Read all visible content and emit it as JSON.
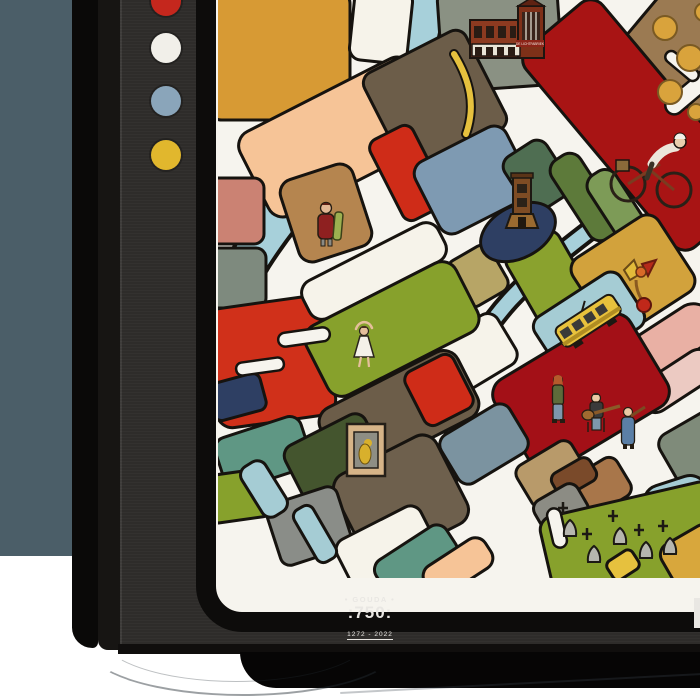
{
  "scene": {
    "wall_color": "#4b5e68",
    "floor_color": "#ffffff",
    "shadow_color": "#060505"
  },
  "frame": {
    "front_color": "#2f2d2b",
    "side_color": "#0a0908",
    "side_color2": "#171513",
    "inner_border_color": "#0d0c0b",
    "dots": [
      {
        "name": "red-dot",
        "color": "#c5271d"
      },
      {
        "name": "white-dot",
        "color": "#f1efe9"
      },
      {
        "name": "blue-dot",
        "color": "#8aa5ba"
      },
      {
        "name": "yellow-dot",
        "color": "#e1b72d"
      }
    ],
    "logo": {
      "line1": "• GOUDA •",
      "line2": ":750:",
      "line3": "1272 - 2022",
      "color": "#e9e7e3"
    }
  },
  "map": {
    "title_depicted": "Stylized illustrated city map of Gouda",
    "factory_label": "DE LICHTFABRIEK",
    "street_color": "#f6f4ee",
    "outline_color": "#16130f",
    "canal_color": "#a7d0da",
    "illustrations": [
      "factory building",
      "cheese wheels",
      "cyclist",
      "church tower",
      "bird sculpture",
      "tram",
      "woman with cheese",
      "dancer",
      "framed painting",
      "street musicians",
      "gravestones"
    ],
    "palette": {
      "ochre": "#d79a34",
      "cream": "#f6f3ea",
      "sage": "#8a9183",
      "cheeseBrown": "#9b7a52",
      "darkRed": "#a81414",
      "wine": "#a31017",
      "red": "#cf2c18",
      "redOrange": "#d0301a",
      "peach": "#f6c497",
      "taupe": "#6c5d49",
      "taupe2": "#6e604d",
      "slateBlue": "#7e9ab2",
      "khaki": "#b7a566",
      "khaki2": "#c9b97c",
      "olive": "#8aa22e",
      "oliveGreen": "#87a12c",
      "forest": "#4f6e52",
      "forestDark": "#44552e",
      "oliveDark": "#5d7a3a",
      "green": "#7d9b57",
      "tan": "#d2a23c",
      "lightBlue": "#a5ccd4",
      "pink": "#e9b0a4",
      "pinkLight": "#eccac2",
      "slateGray": "#7b93a0",
      "tanLight": "#b89a6a",
      "sienna": "#a8764a",
      "gray": "#8c8c84",
      "grayCorner": "#8a8d88",
      "brownDark": "#7a4a2a",
      "navy": "#2e3f63",
      "salmonDark": "#cb8273",
      "tanWoman": "#b5854f",
      "grayGreen": "#7e8a7e",
      "teal": "#5f9784",
      "mauveGray": "#7f8b7a",
      "yellow": "#e6c13e",
      "ochreCorner": "#d8a73c"
    },
    "canals": [
      {
        "d": "M 208,-8 C 202,48 190,86 152,120 C 112,156 66,206 34,256 C 18,282 8,306 -6,336",
        "w": 36
      },
      {
        "d": "M -8,72 C 36,80 72,96 104,122",
        "w": 24
      },
      {
        "d": "M 388,218 C 348,248 318,272 292,300 C 272,322 252,352 240,388",
        "w": 14
      },
      {
        "d": "M 240,384 C 234,422 238,452 228,488 C 222,512 212,540 198,566",
        "w": 12
      }
    ],
    "yellow_roads": [
      {
        "d": "M 236,54 C 252,80 258,106 248,134",
        "w": 6
      }
    ],
    "parcels": [
      {
        "fill": "ochre",
        "x": -12,
        "y": -12,
        "w": 144,
        "h": 132,
        "rx": 16,
        "rot": 0
      },
      {
        "fill": "cream",
        "x": 134,
        "y": -12,
        "w": 58,
        "h": 74,
        "rx": 12,
        "rot": 6
      },
      {
        "fill": "sage",
        "x": 222,
        "y": -14,
        "w": 120,
        "h": 102,
        "rx": 12,
        "rot": -4
      },
      {
        "fill": "lightBlue",
        "x": 408,
        "y": -20,
        "w": 26,
        "h": 150,
        "rx": 12,
        "rot": 42
      },
      {
        "fill": "cheeseBrown",
        "x": 412,
        "y": -26,
        "w": 104,
        "h": 152,
        "rx": 16,
        "rot": 40
      },
      {
        "fill": "darkRed",
        "x": 290,
        "y": 75,
        "w": 260,
        "h": 100,
        "rx": 16,
        "rot": 50
      },
      {
        "fill": "peach",
        "x": 26,
        "y": 90,
        "w": 192,
        "h": 94,
        "rx": 16,
        "rot": -27
      },
      {
        "fill": "taupe",
        "x": 160,
        "y": 46,
        "w": 114,
        "h": 110,
        "rx": 12,
        "rot": -27
      },
      {
        "fill": "red",
        "x": 166,
        "y": 128,
        "w": 48,
        "h": 90,
        "rx": 10,
        "rot": -27
      },
      {
        "fill": "slateBlue",
        "x": 204,
        "y": 140,
        "w": 102,
        "h": 80,
        "rx": 14,
        "rot": -27
      },
      {
        "fill": "forest",
        "x": 294,
        "y": 144,
        "w": 50,
        "h": 64,
        "rx": 12,
        "rot": -33
      },
      {
        "fill": "oliveDark",
        "x": 350,
        "y": 150,
        "w": 34,
        "h": 94,
        "rx": 13,
        "rot": -33
      },
      {
        "fill": "green",
        "x": 386,
        "y": 166,
        "w": 32,
        "h": 90,
        "rx": 13,
        "rot": -33
      },
      {
        "fill": "khaki",
        "x": 236,
        "y": 250,
        "w": 48,
        "h": 52,
        "rx": 10,
        "rot": -30
      },
      {
        "fill": "khaki2",
        "x": 194,
        "y": 276,
        "w": 44,
        "h": 48,
        "rx": 10,
        "rot": -30
      },
      {
        "fill": "olive",
        "x": 300,
        "y": 236,
        "w": 60,
        "h": 82,
        "rx": 12,
        "rot": -30
      },
      {
        "fill": "tan",
        "x": 364,
        "y": 230,
        "w": 102,
        "h": 90,
        "rx": 14,
        "rot": -33
      },
      {
        "fill": "lightBlue",
        "x": 320,
        "y": 290,
        "w": 102,
        "h": 64,
        "rx": 12,
        "rot": -33
      },
      {
        "fill": "pink",
        "x": 400,
        "y": 320,
        "w": 102,
        "h": 44,
        "rx": 21,
        "rot": -33
      },
      {
        "fill": "pinkLight",
        "x": 416,
        "y": 364,
        "w": 86,
        "h": 34,
        "rx": 16,
        "rot": -33
      },
      {
        "fill": "wine",
        "x": 284,
        "y": 340,
        "w": 158,
        "h": 106,
        "rx": 18,
        "rot": -31
      },
      {
        "fill": "cream",
        "x": 220,
        "y": 324,
        "w": 74,
        "h": 58,
        "rx": 12,
        "rot": -31
      },
      {
        "fill": "slateGray",
        "x": 226,
        "y": 416,
        "w": 80,
        "h": 56,
        "rx": 12,
        "rot": -31
      },
      {
        "fill": "tanLight",
        "x": 302,
        "y": 450,
        "w": 64,
        "h": 48,
        "rx": 10,
        "rot": -31
      },
      {
        "fill": "sienna",
        "x": 350,
        "y": 466,
        "w": 60,
        "h": 44,
        "rx": 10,
        "rot": -31
      },
      {
        "fill": "brownDark",
        "x": 334,
        "y": 464,
        "w": 44,
        "h": 26,
        "rx": 8,
        "rot": -30
      },
      {
        "fill": "gray",
        "x": 318,
        "y": 490,
        "w": 50,
        "h": 38,
        "rx": 10,
        "rot": -30
      },
      {
        "fill": "mauveGray",
        "x": 446,
        "y": 418,
        "w": 72,
        "h": 58,
        "rx": 12,
        "rot": -30
      },
      {
        "fill": "lightBlue",
        "x": 426,
        "y": 480,
        "w": 66,
        "h": 44,
        "rx": 18,
        "rot": -18
      },
      {
        "fill": "oliveGreen",
        "x": 328,
        "y": 498,
        "w": 178,
        "h": 96,
        "rx": 14,
        "rot": -13
      },
      {
        "fill": "salmonDark",
        "x": -10,
        "y": 178,
        "w": 56,
        "h": 66,
        "rx": 10,
        "rot": 0
      },
      {
        "fill": "tanWoman",
        "x": 70,
        "y": 170,
        "w": 76,
        "h": 86,
        "rx": 14,
        "rot": -18
      },
      {
        "fill": "grayGreen",
        "x": -10,
        "y": 248,
        "w": 58,
        "h": 60,
        "rx": 10,
        "rot": 0
      },
      {
        "fill": "redOrange",
        "x": -8,
        "y": 302,
        "w": 120,
        "h": 120,
        "rx": 16,
        "rot": -8
      },
      {
        "fill": "navy",
        "x": -8,
        "y": 378,
        "w": 54,
        "h": 38,
        "rx": 8,
        "rot": -15
      },
      {
        "fill": "teal",
        "x": 0,
        "y": 426,
        "w": 90,
        "h": 54,
        "rx": 12,
        "rot": -18
      },
      {
        "fill": "oliveGreen",
        "x": -12,
        "y": 472,
        "w": 64,
        "h": 48,
        "rx": 10,
        "rot": -8
      },
      {
        "fill": "cream",
        "x": 80,
        "y": 250,
        "w": 152,
        "h": 42,
        "rx": 14,
        "rot": -27
      },
      {
        "fill": "oliveGreen",
        "x": 90,
        "y": 290,
        "w": 168,
        "h": 78,
        "rx": 16,
        "rot": -27
      },
      {
        "fill": "taupe",
        "x": 104,
        "y": 376,
        "w": 154,
        "h": 74,
        "rx": 16,
        "rot": -27
      },
      {
        "fill": "red",
        "x": 194,
        "y": 360,
        "w": 54,
        "h": 60,
        "rx": 10,
        "rot": -27
      },
      {
        "fill": "forestDark",
        "x": 74,
        "y": 426,
        "w": 90,
        "h": 74,
        "rx": 12,
        "rot": -27
      },
      {
        "fill": "taupe2",
        "x": 126,
        "y": 450,
        "w": 114,
        "h": 98,
        "rx": 16,
        "rot": -27
      },
      {
        "fill": "grayCorner",
        "x": 54,
        "y": 494,
        "w": 74,
        "h": 64,
        "rx": 10,
        "rot": -18
      },
      {
        "fill": "cream",
        "x": 122,
        "y": 520,
        "w": 94,
        "h": 58,
        "rx": 12,
        "rot": -27
      },
      {
        "fill": "lightBlue",
        "x": 32,
        "y": 460,
        "w": 28,
        "h": 58,
        "rx": 10,
        "rot": -32
      },
      {
        "fill": "lightBlue",
        "x": 86,
        "y": 504,
        "w": 22,
        "h": 60,
        "rx": 8,
        "rot": -30
      },
      {
        "fill": "teal",
        "x": 156,
        "y": 540,
        "w": 84,
        "h": 40,
        "rx": 12,
        "rot": -33
      },
      {
        "fill": "peach",
        "x": 204,
        "y": 550,
        "w": 72,
        "h": 34,
        "rx": 12,
        "rot": -33
      },
      {
        "fill": "yellow",
        "x": 390,
        "y": 554,
        "w": 30,
        "h": 22,
        "rx": 6,
        "rot": -33
      },
      {
        "fill": "ochreCorner",
        "x": 446,
        "y": 532,
        "w": 60,
        "h": 48,
        "rx": 12,
        "rot": -30
      }
    ],
    "street_stubs": [
      {
        "x": 468,
        "y": 52,
        "w": 18,
        "h": 72,
        "rx": 9,
        "rot": 50
      },
      {
        "x": 444,
        "y": 60,
        "w": 40,
        "h": 12,
        "rx": 6,
        "rot": 40
      },
      {
        "x": 60,
        "y": 330,
        "w": 52,
        "h": 14,
        "rx": 7,
        "rot": -8
      },
      {
        "x": 18,
        "y": 360,
        "w": 48,
        "h": 13,
        "rx": 6,
        "rot": -8
      },
      {
        "x": 332,
        "y": 508,
        "w": 14,
        "h": 40,
        "rx": 7,
        "rot": -13
      }
    ]
  }
}
